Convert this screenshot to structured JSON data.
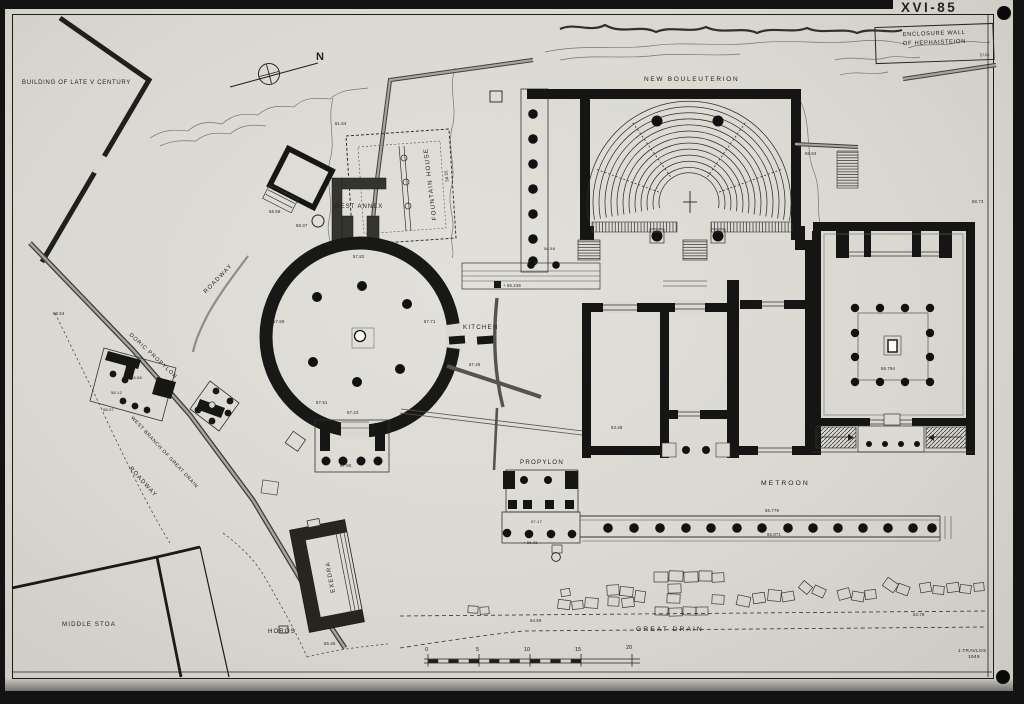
{
  "labels": {
    "sheet_number": "XVI-85",
    "enclosure_line1": "ENCLOSURE WALL",
    "enclosure_line2": "OF HEPHAISTEION",
    "enclosure_elev": "57.61",
    "building_late_v": "BUILDING OF LATE V CENTURY",
    "north_n": "N",
    "elev_6164": "61.64",
    "fountain_house": "FOUNTAIN HOUSE",
    "elev_5855": "58.55",
    "west_annex": "WEST ANNEX",
    "elev_5856": "58.56",
    "elev_5837": "58.37",
    "roadway_1": "ROADWAY",
    "elev_5782": "57.82",
    "elev_5769": "57.69",
    "elev_5771": "57.71",
    "elev_5791": "57.91",
    "elev_5743": "57.43",
    "elev_5765": "57.65",
    "kitchen": "KITCHEN",
    "elev_5746": "57.46",
    "elev_5654": "56.54",
    "doric_propylon": "DORIC PROPYLON",
    "elev_5886": "58.86",
    "elev_5812": "58.12",
    "elev_5807": "58.07",
    "west_branch": "WEST BRANCH OF GREAT DRAIN",
    "roadway_2": "ROADWAY",
    "middle_stoa": "MIDDLE STOA",
    "horos": "HOROS",
    "exedra": "EXEDRA",
    "elev_5546": "55.46",
    "great_drain": "GREAT DRAIN",
    "elev_5459": "54.59",
    "elev_5378": "53.78",
    "scale_0": "0",
    "scale_5": "5",
    "scale_10": "10",
    "scale_15": "15",
    "scale_20": "20",
    "signature_name": "J.TRAVLOS",
    "signature_year": "1949",
    "new_bouleuterion": "NEW BOULEUTERION",
    "elev_5858": "58.58",
    "elev_5884": "58.84",
    "elev_5873": "58.73",
    "elev_55236": "+ 55.236",
    "propylon": "PROPYLON",
    "elev_5717": "57.17",
    "elev_5625": "+ 56.25",
    "metroon": "METROON",
    "elev_56779": "56.779",
    "elev_55871": "55.871",
    "elev_56794": "56.794",
    "elev_5348": "53.48"
  },
  "colors": {
    "photo_background": "#131313",
    "paper": "#dad8d1",
    "ink": "#23231f",
    "wall_gray": "#55534d"
  }
}
